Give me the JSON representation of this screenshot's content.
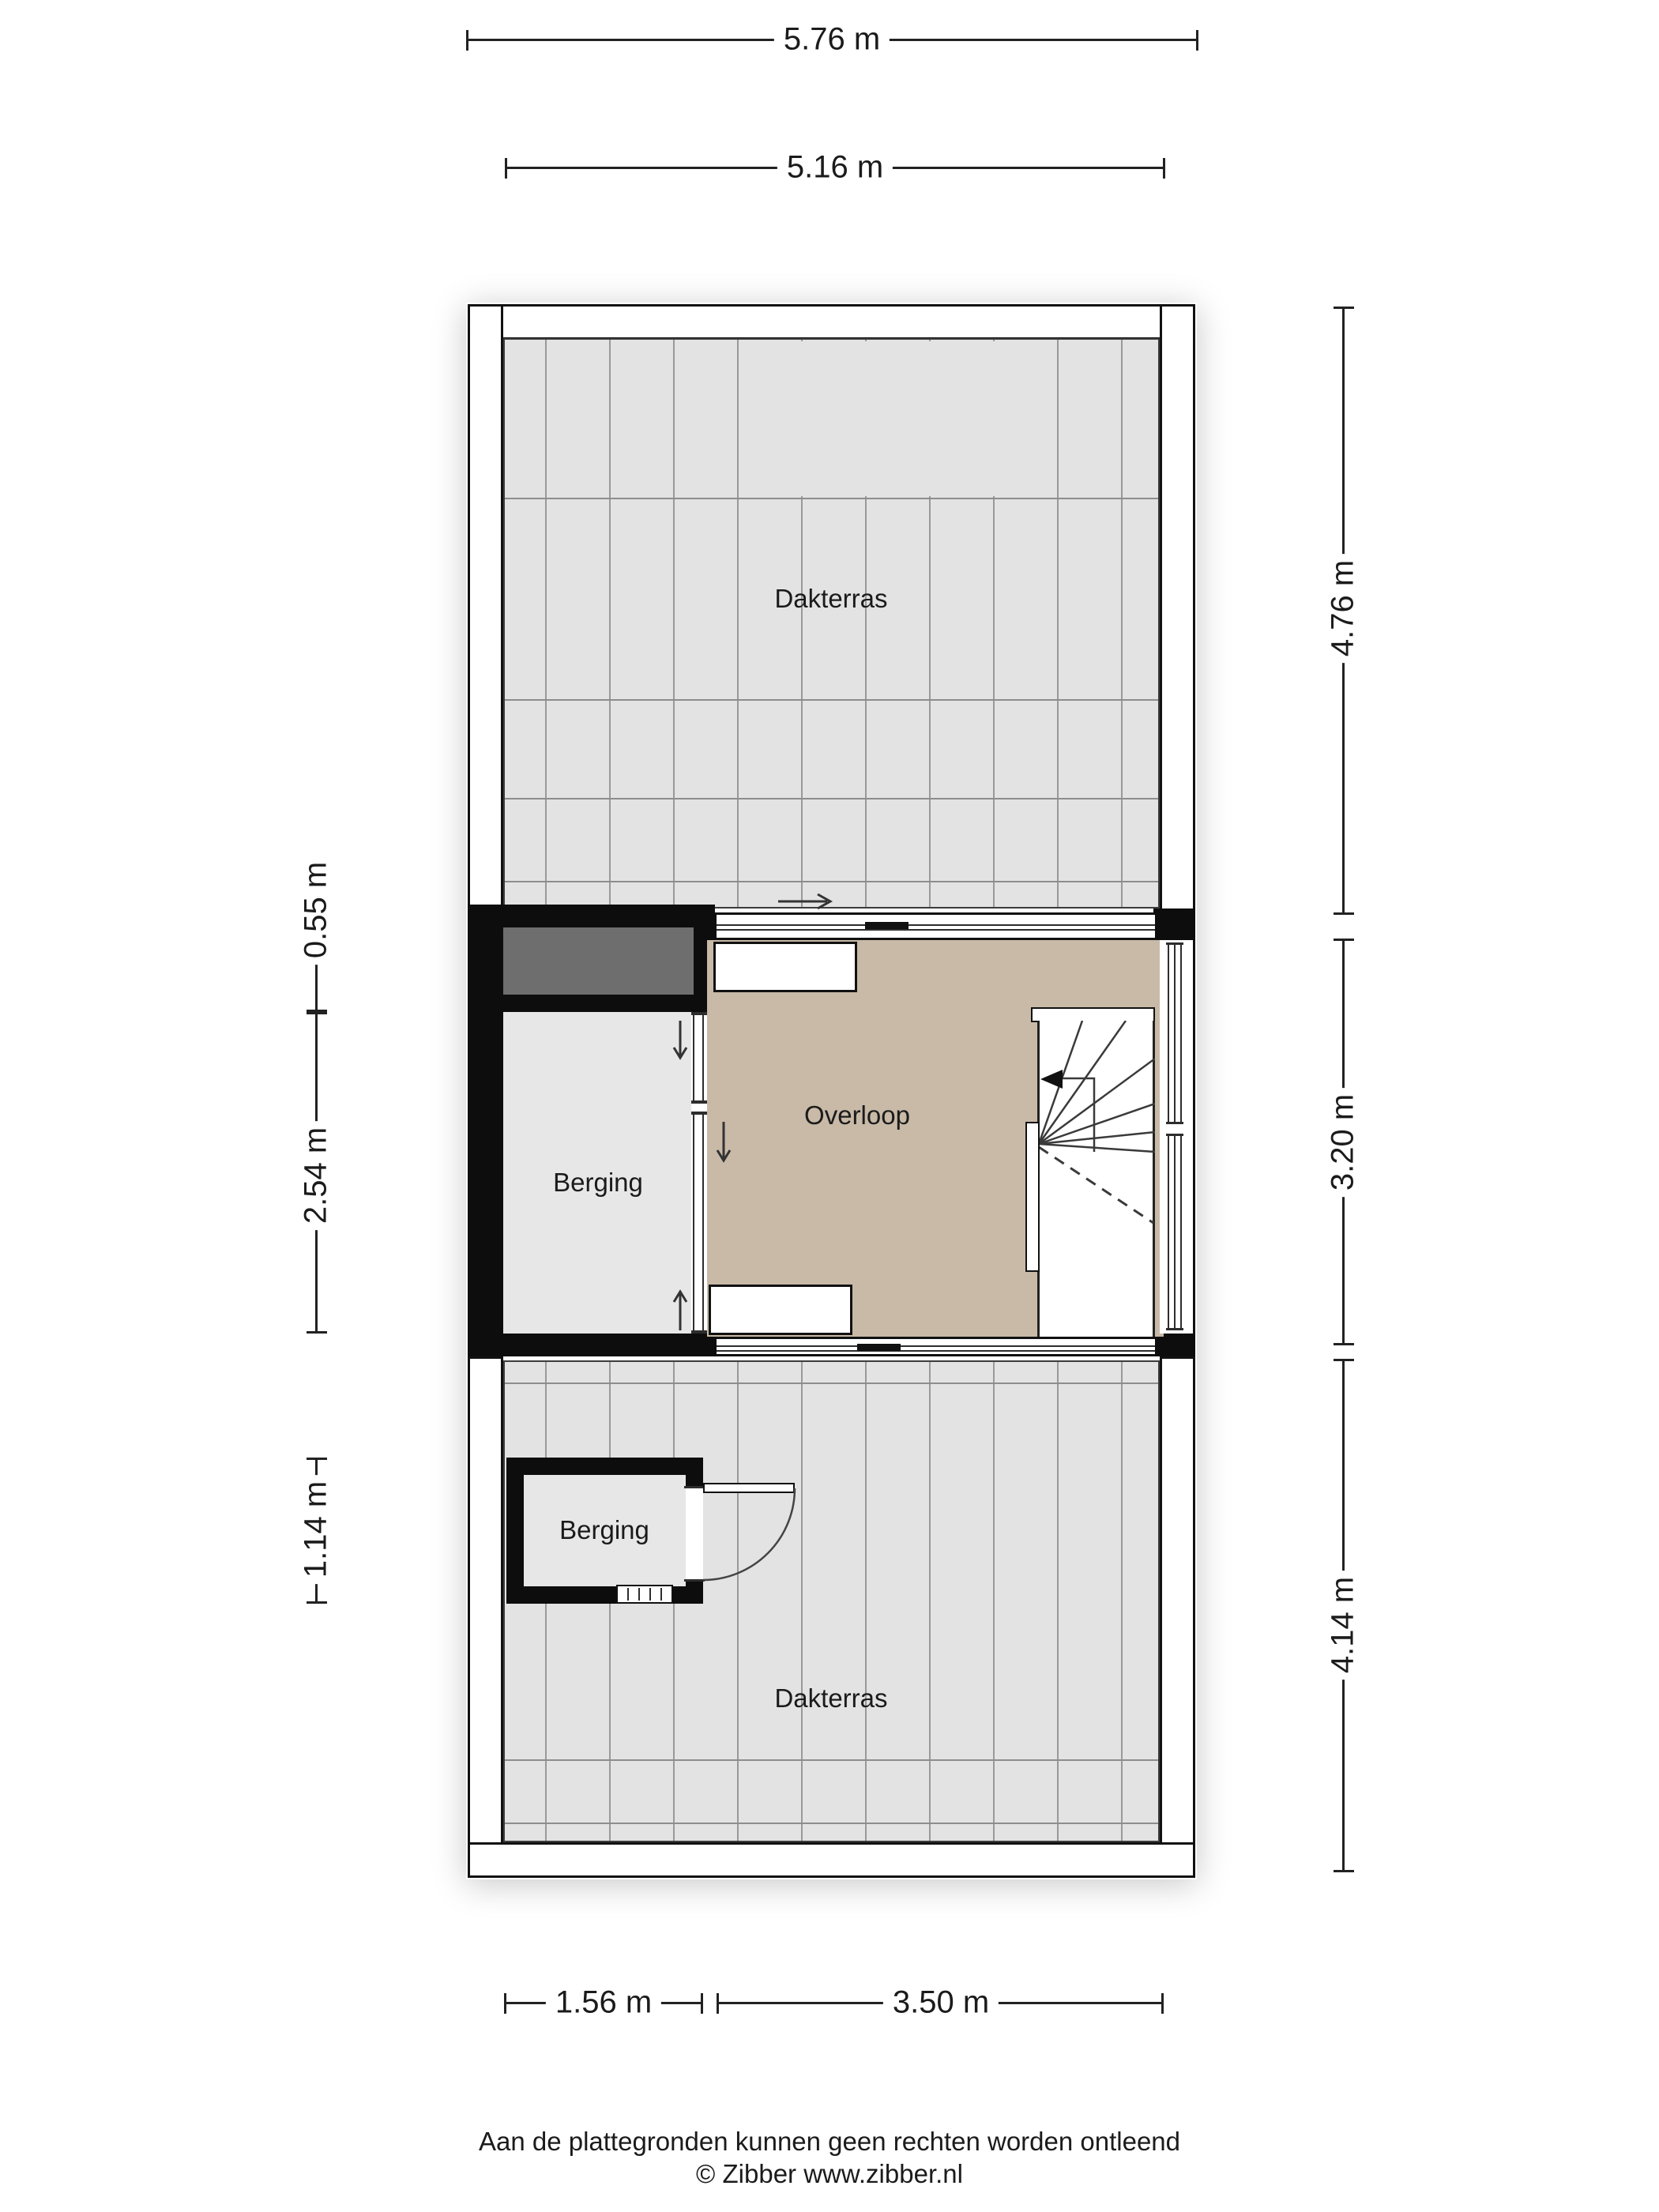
{
  "plan": {
    "rooms": {
      "dakterras_top": "Dakterras",
      "berging_middle": "Berging",
      "overloop": "Overloop",
      "berging_bottom": "Berging",
      "dakterras_bottom": "Dakterras"
    },
    "dimensions": {
      "width_outer": "5.76 m",
      "width_inner": "5.16 m",
      "right_top": "4.76 m",
      "right_middle": "3.20 m",
      "right_bottom": "4.14 m",
      "left_top": "0.55 m",
      "left_middle": "2.54 m",
      "left_bottom": "1.14 m",
      "bottom_left": "1.56 m",
      "bottom_right": "3.50 m"
    },
    "colors": {
      "wall_black": "#0d0d0d",
      "tile_floor_grey": "#e3e3e3",
      "storage_floor_grey": "#e7e7e7",
      "landing_floor_beige": "#c8baa7",
      "roof_element_dark_grey": "#6e6e6e",
      "line_dark": "#222222"
    }
  },
  "footer": {
    "disclaimer": "Aan de plattegronden kunnen geen rechten worden ontleend",
    "credit": "© Zibber www.zibber.nl"
  }
}
